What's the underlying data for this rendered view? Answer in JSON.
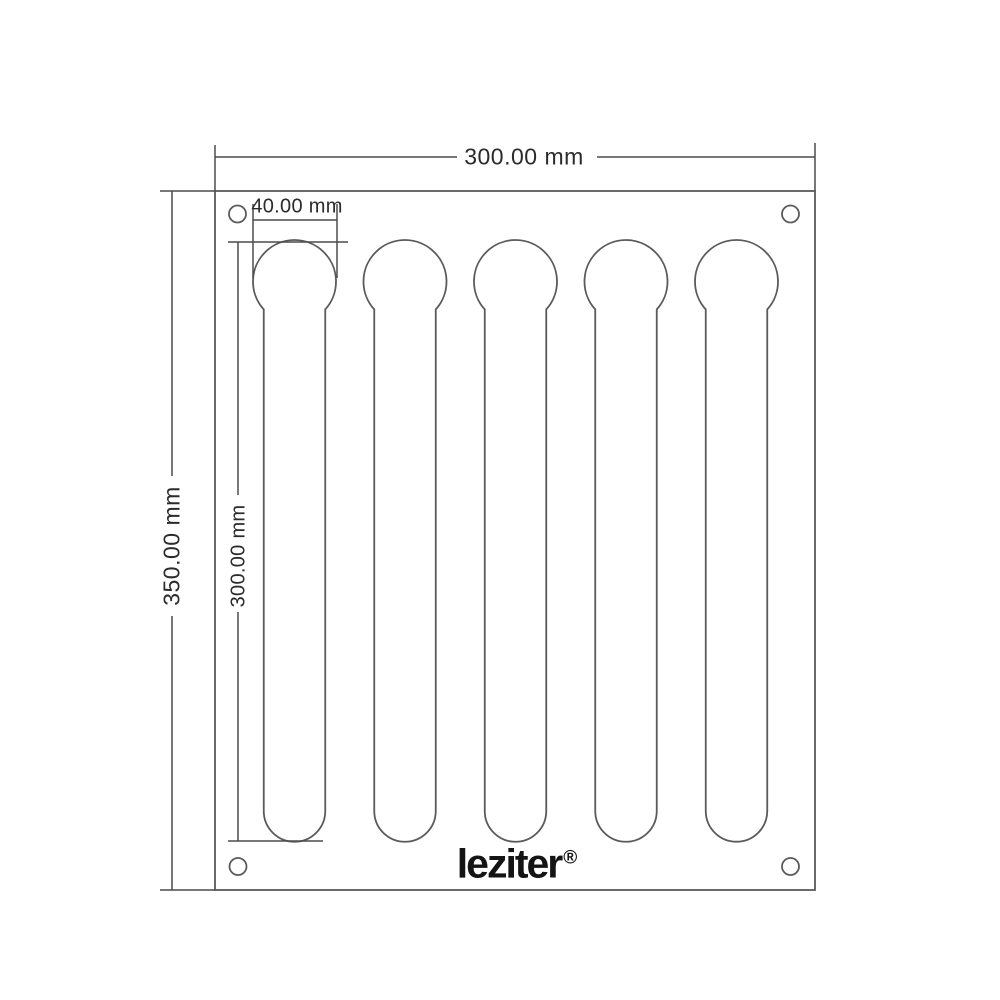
{
  "labels": {
    "overall_width": "300.00 mm",
    "overall_height": "350.00 mm",
    "slot_length": "300.00 mm",
    "slot_width": "40.00 mm"
  },
  "brand": {
    "name": "leziter",
    "mark": "®"
  },
  "plate": {
    "slot_count": 5,
    "corner_hole_count": 4
  },
  "colors": {
    "outline": "#5a5a5a",
    "dimension": "#4c4c4c",
    "text": "#2b2b2b",
    "logo": "#141414",
    "background": "#ffffff"
  }
}
